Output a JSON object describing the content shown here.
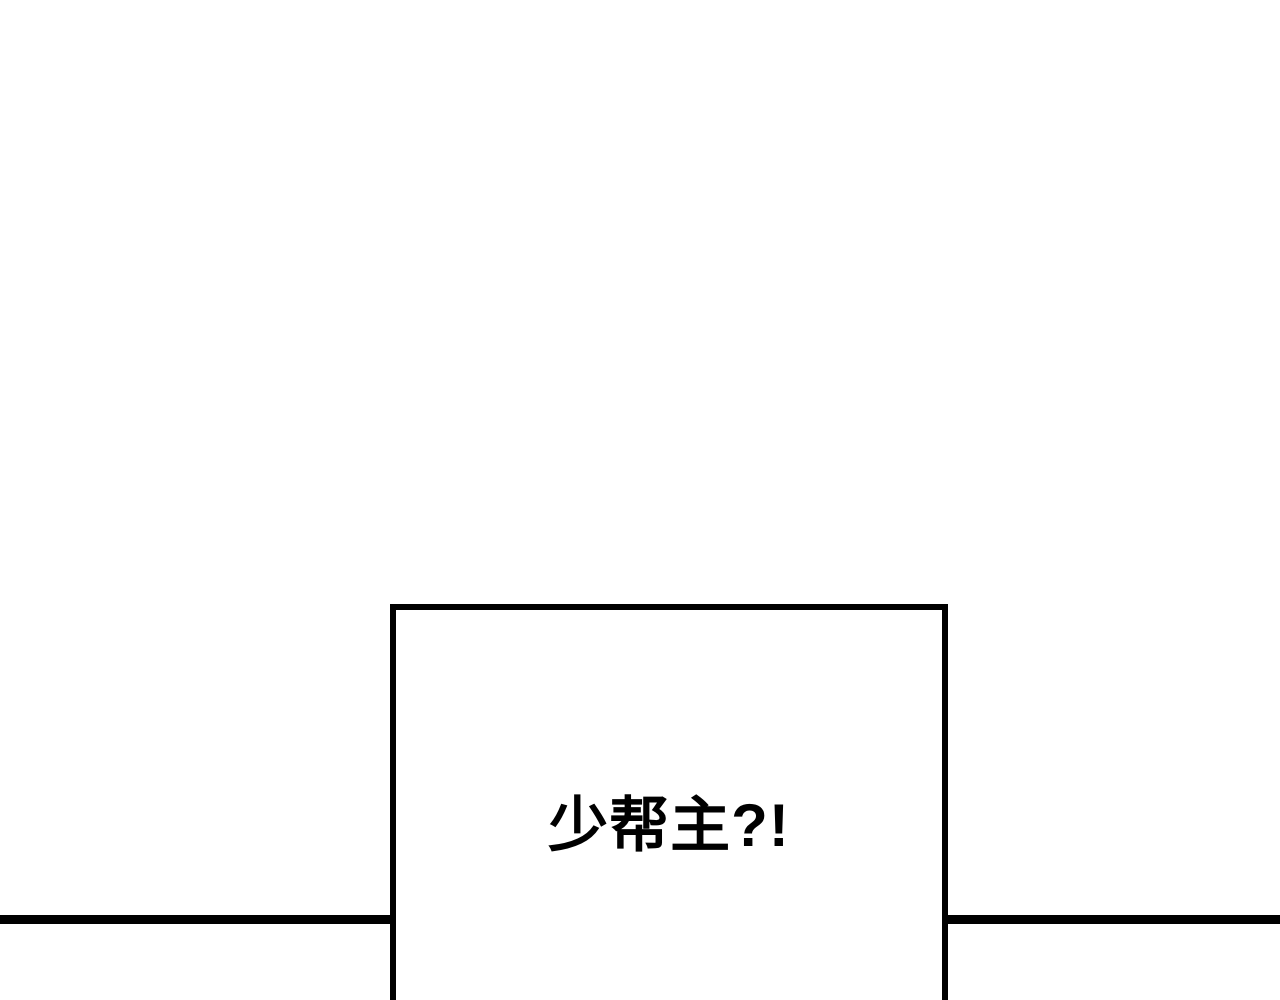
{
  "panel": {
    "dialogue_text": "少帮主?!"
  },
  "colors": {
    "background": "#ffffff",
    "divider_line": "#000000",
    "box_border": "#000000",
    "text": "#000000"
  }
}
